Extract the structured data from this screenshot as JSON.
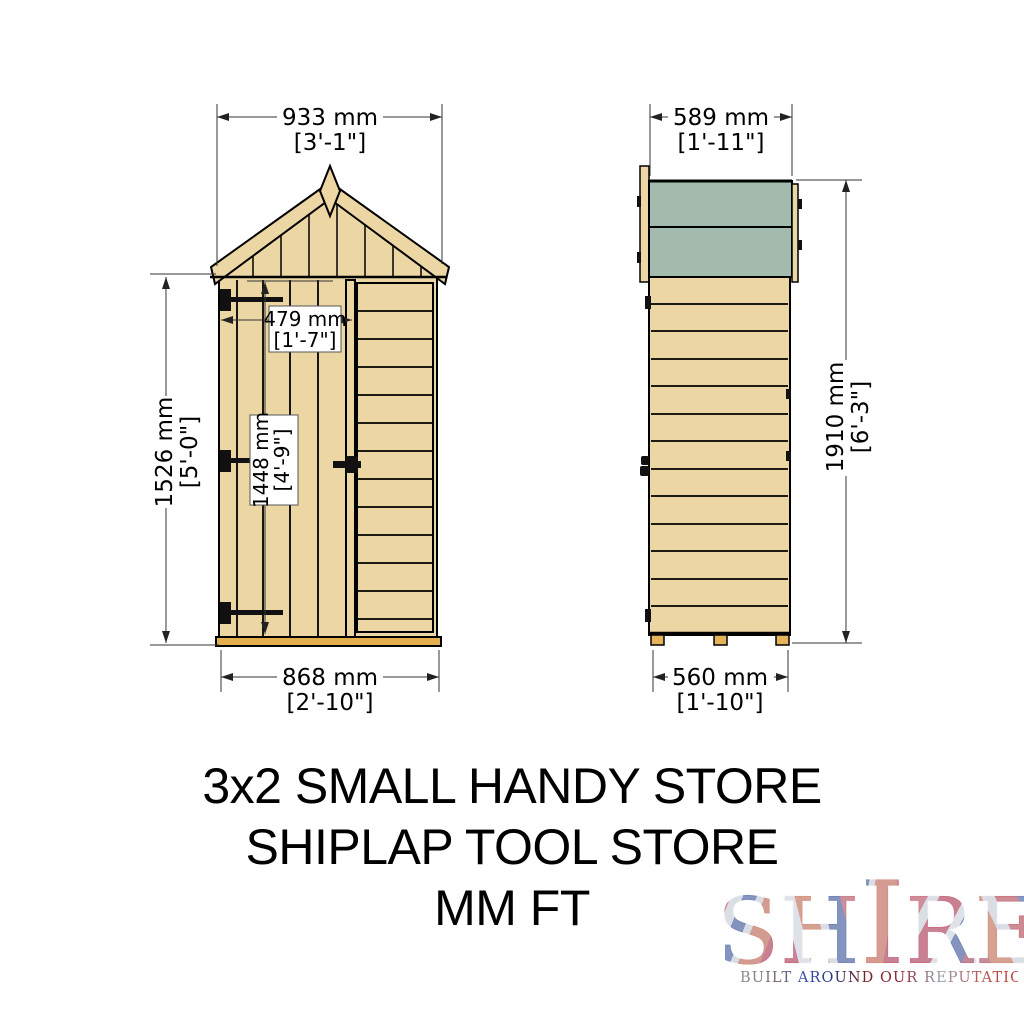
{
  "drawing": {
    "front_view": {
      "name": "front elevation",
      "dims": {
        "overall_width": {
          "mm": "933 mm",
          "ft": "[3'-1\"]"
        },
        "door_width": {
          "mm": "479 mm",
          "ft": "[1'-7\"]"
        },
        "eaves_height": {
          "mm": "1526 mm",
          "ft": "[5'-0\"]"
        },
        "door_height": {
          "mm": "1448 mm",
          "ft": "[4'-9\"]"
        },
        "base_width": {
          "mm": "868 mm",
          "ft": "[2'-10\"]"
        }
      }
    },
    "side_view": {
      "name": "side elevation",
      "dims": {
        "roof_depth": {
          "mm": "589 mm",
          "ft": "[1'-11\"]"
        },
        "overall_height": {
          "mm": "1910 mm",
          "ft": "[6'-3\"]"
        },
        "base_depth": {
          "mm": "560 mm",
          "ft": "[1'-10\"]"
        }
      }
    }
  },
  "title": {
    "line1": "3x2 SMALL HANDY STORE",
    "line2": "SHIPLAP TOOL STORE",
    "line3": "MM FT"
  },
  "logo": {
    "name": "SHIRE",
    "letters": [
      "S",
      "H",
      "I",
      "R",
      "E"
    ],
    "tagline": "BUILT AROUND OUR REPUTATION"
  },
  "colors": {
    "wood": "#ecd7a4",
    "roof_felt": "#a2bbac",
    "base_rail": "#e2ae4e",
    "outline": "#000000",
    "logo_red": "#c8102e",
    "logo_blue": "#21409a"
  }
}
